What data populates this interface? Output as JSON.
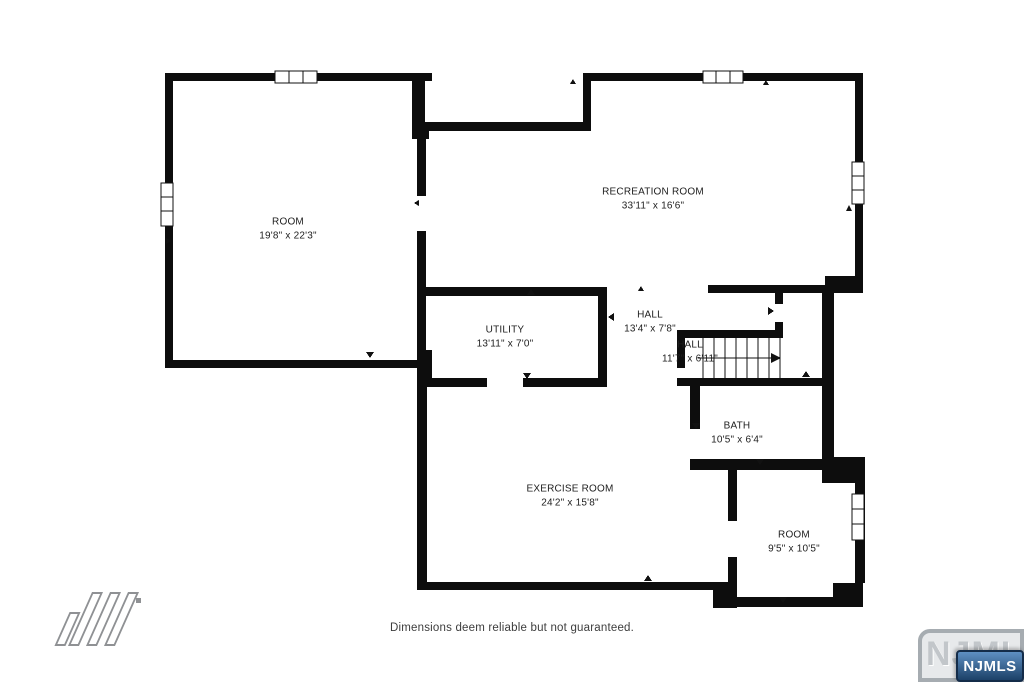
{
  "rooms": [
    {
      "name": "ROOM",
      "dims": "19'8\" x 22'3\""
    },
    {
      "name": "RECREATION ROOM",
      "dims": "33'11\" x 16'6\""
    },
    {
      "name": "UTILITY",
      "dims": "13'11\" x 7'0\""
    },
    {
      "name": "HALL",
      "dims": "13'4\" x 7'8\""
    },
    {
      "name": "HALL",
      "dims": "11'7\" x 6'11\""
    },
    {
      "name": "BATH",
      "dims": "10'5\" x 6'4\""
    },
    {
      "name": "EXERCISE ROOM",
      "dims": "24'2\" x 15'8\""
    },
    {
      "name": "ROOM",
      "dims": "9'5\" x 10'5\""
    }
  ],
  "footer": {
    "disclaimer": "Dimensions deem reliable but not guaranteed."
  },
  "branding": {
    "watermark_text": "NJMLS",
    "badge_text": "NJMLS",
    "badge_color": "#1c4168",
    "maker_logo_icon": "diagonal-bars-logo"
  },
  "colors": {
    "walls": "#0d0d0d",
    "background": "#ffffff"
  }
}
